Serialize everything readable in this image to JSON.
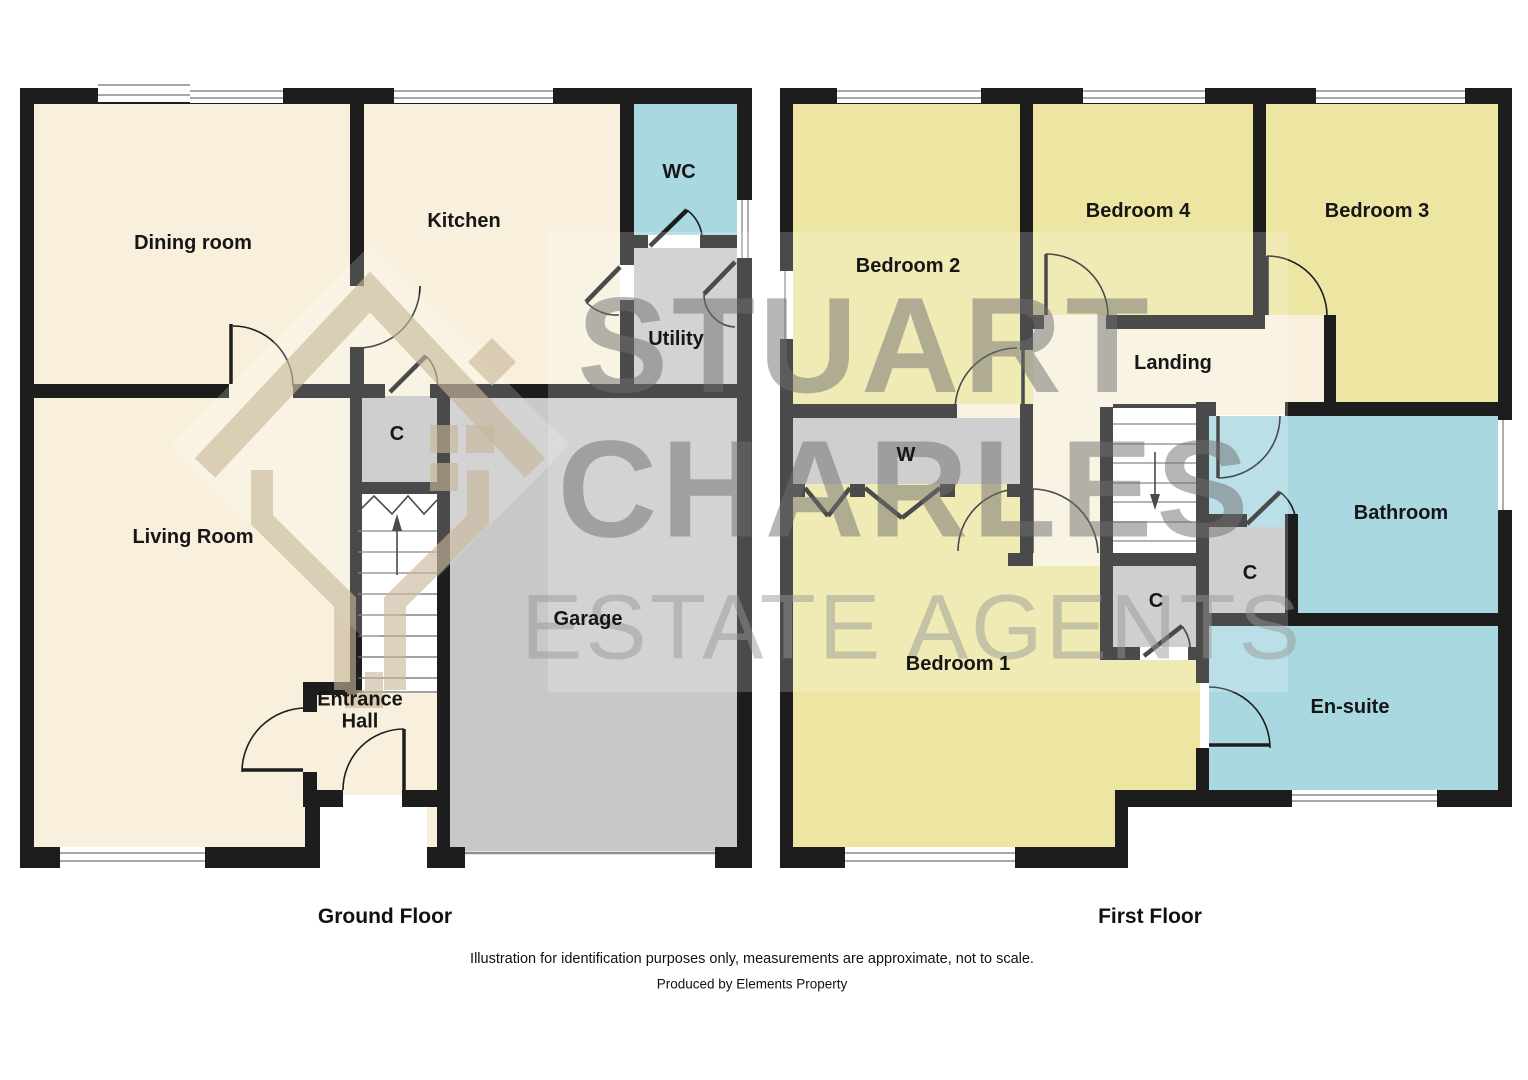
{
  "watermark": {
    "line1": "STUART",
    "line2": "CHARLES",
    "line3": "ESTATE AGENTS"
  },
  "ground_floor": {
    "title": "Ground Floor",
    "rooms": {
      "dining": "Dining room",
      "kitchen": "Kitchen",
      "wc": "WC",
      "utility": "Utility",
      "cupboard": "C",
      "living": "Living Room",
      "entrance_hall": "Entrance Hall",
      "garage": "Garage"
    }
  },
  "first_floor": {
    "title": "First Floor",
    "rooms": {
      "bedroom2": "Bedroom 2",
      "bedroom4": "Bedroom 4",
      "bedroom3": "Bedroom 3",
      "landing": "Landing",
      "wardrobe": "W",
      "bathroom": "Bathroom",
      "cupboard_bath": "C",
      "cupboard_stairs": "C",
      "bedroom1": "Bedroom 1",
      "ensuite": "En-suite"
    }
  },
  "footer": {
    "disclaimer": "Illustration for identification purposes only, measurements are approximate, not to scale.",
    "producer": "Produced by Elements Property"
  },
  "colors": {
    "room_cream": "#F8F0DC",
    "room_yellow": "#EDE6A2",
    "room_blue": "#A9D8E0",
    "garage_gray": "#C8C8C8",
    "cupboard_gray": "#C3C3C3",
    "wall_black": "#1D1D1D",
    "watermark_gray": "#6E6E6E",
    "watermark_tan": "#C7B698"
  }
}
